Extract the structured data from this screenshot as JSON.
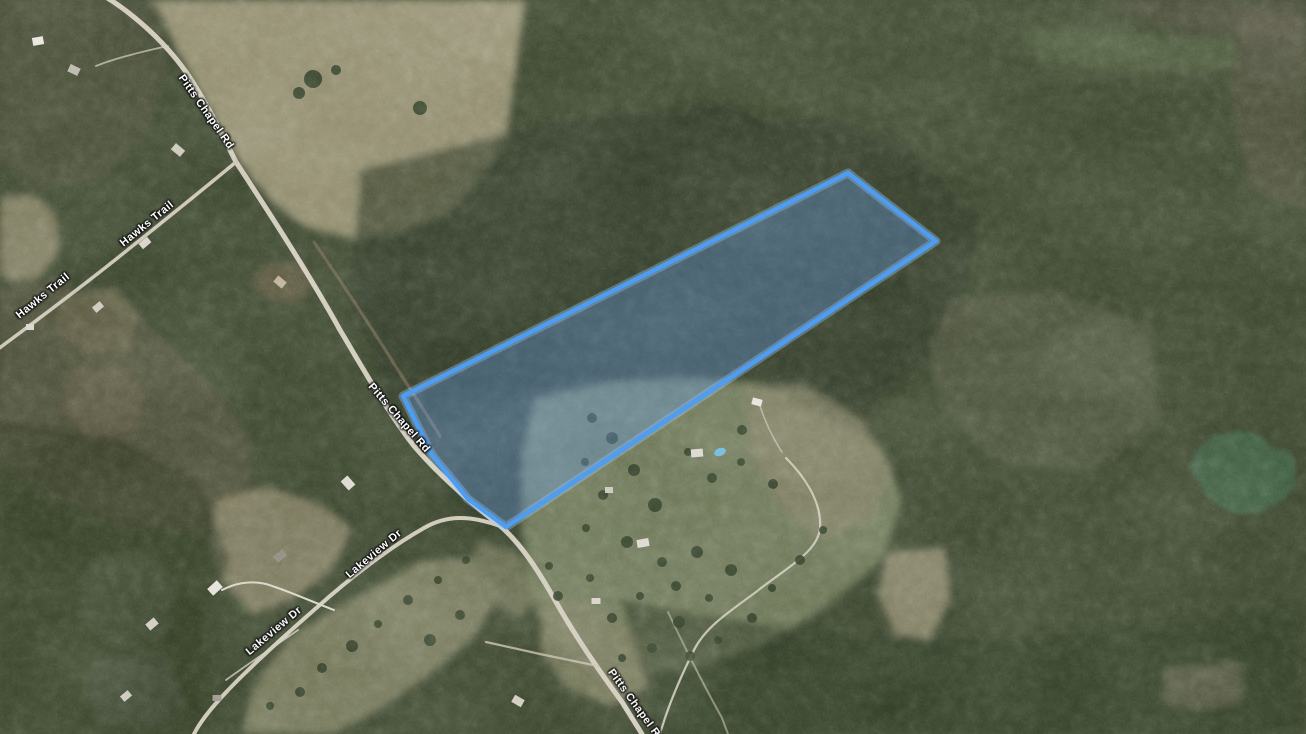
{
  "map": {
    "type": "satellite-imagery",
    "road_labels": [
      {
        "id": "pitts-chapel-rd-1",
        "text": "Pitts Chapel Rd",
        "x": 206,
        "y": 112,
        "rotation_deg": 55
      },
      {
        "id": "pitts-chapel-rd-2",
        "text": "Pitts Chapel Rd",
        "x": 399,
        "y": 418,
        "rotation_deg": 49
      },
      {
        "id": "pitts-chapel-rd-3",
        "text": "Pitts Chapel Rd",
        "x": 636,
        "y": 706,
        "rotation_deg": 54
      },
      {
        "id": "hawks-trail-1",
        "text": "Hawks Trail",
        "x": 147,
        "y": 224,
        "rotation_deg": -39
      },
      {
        "id": "hawks-trail-2",
        "text": "Hawks Trail",
        "x": 43,
        "y": 296,
        "rotation_deg": -39
      },
      {
        "id": "lakeview-dr-1",
        "text": "Lakeview Dr",
        "x": 374,
        "y": 554,
        "rotation_deg": -40
      },
      {
        "id": "lakeview-dr-2",
        "text": "Lakeview Dr",
        "x": 274,
        "y": 631,
        "rotation_deg": -40
      }
    ],
    "parcel": {
      "points": "403,396 848,173 936,241 506,527 468,499 432,455",
      "outline_color": "#4D9DF2",
      "halo_color": "#A6CEF9",
      "fill_color": "rgba(106,162,244,0.33)"
    },
    "label_style": {
      "text_color": "#FFFFFF",
      "outline_color": "#141414"
    },
    "palette": {
      "forest_base": "#39432c",
      "forest_dark": "#2c3722",
      "field_tan": "#918c6e",
      "field_green": "#6c7655",
      "road": "#cdc7b7",
      "pond": "#3d5b41"
    }
  }
}
